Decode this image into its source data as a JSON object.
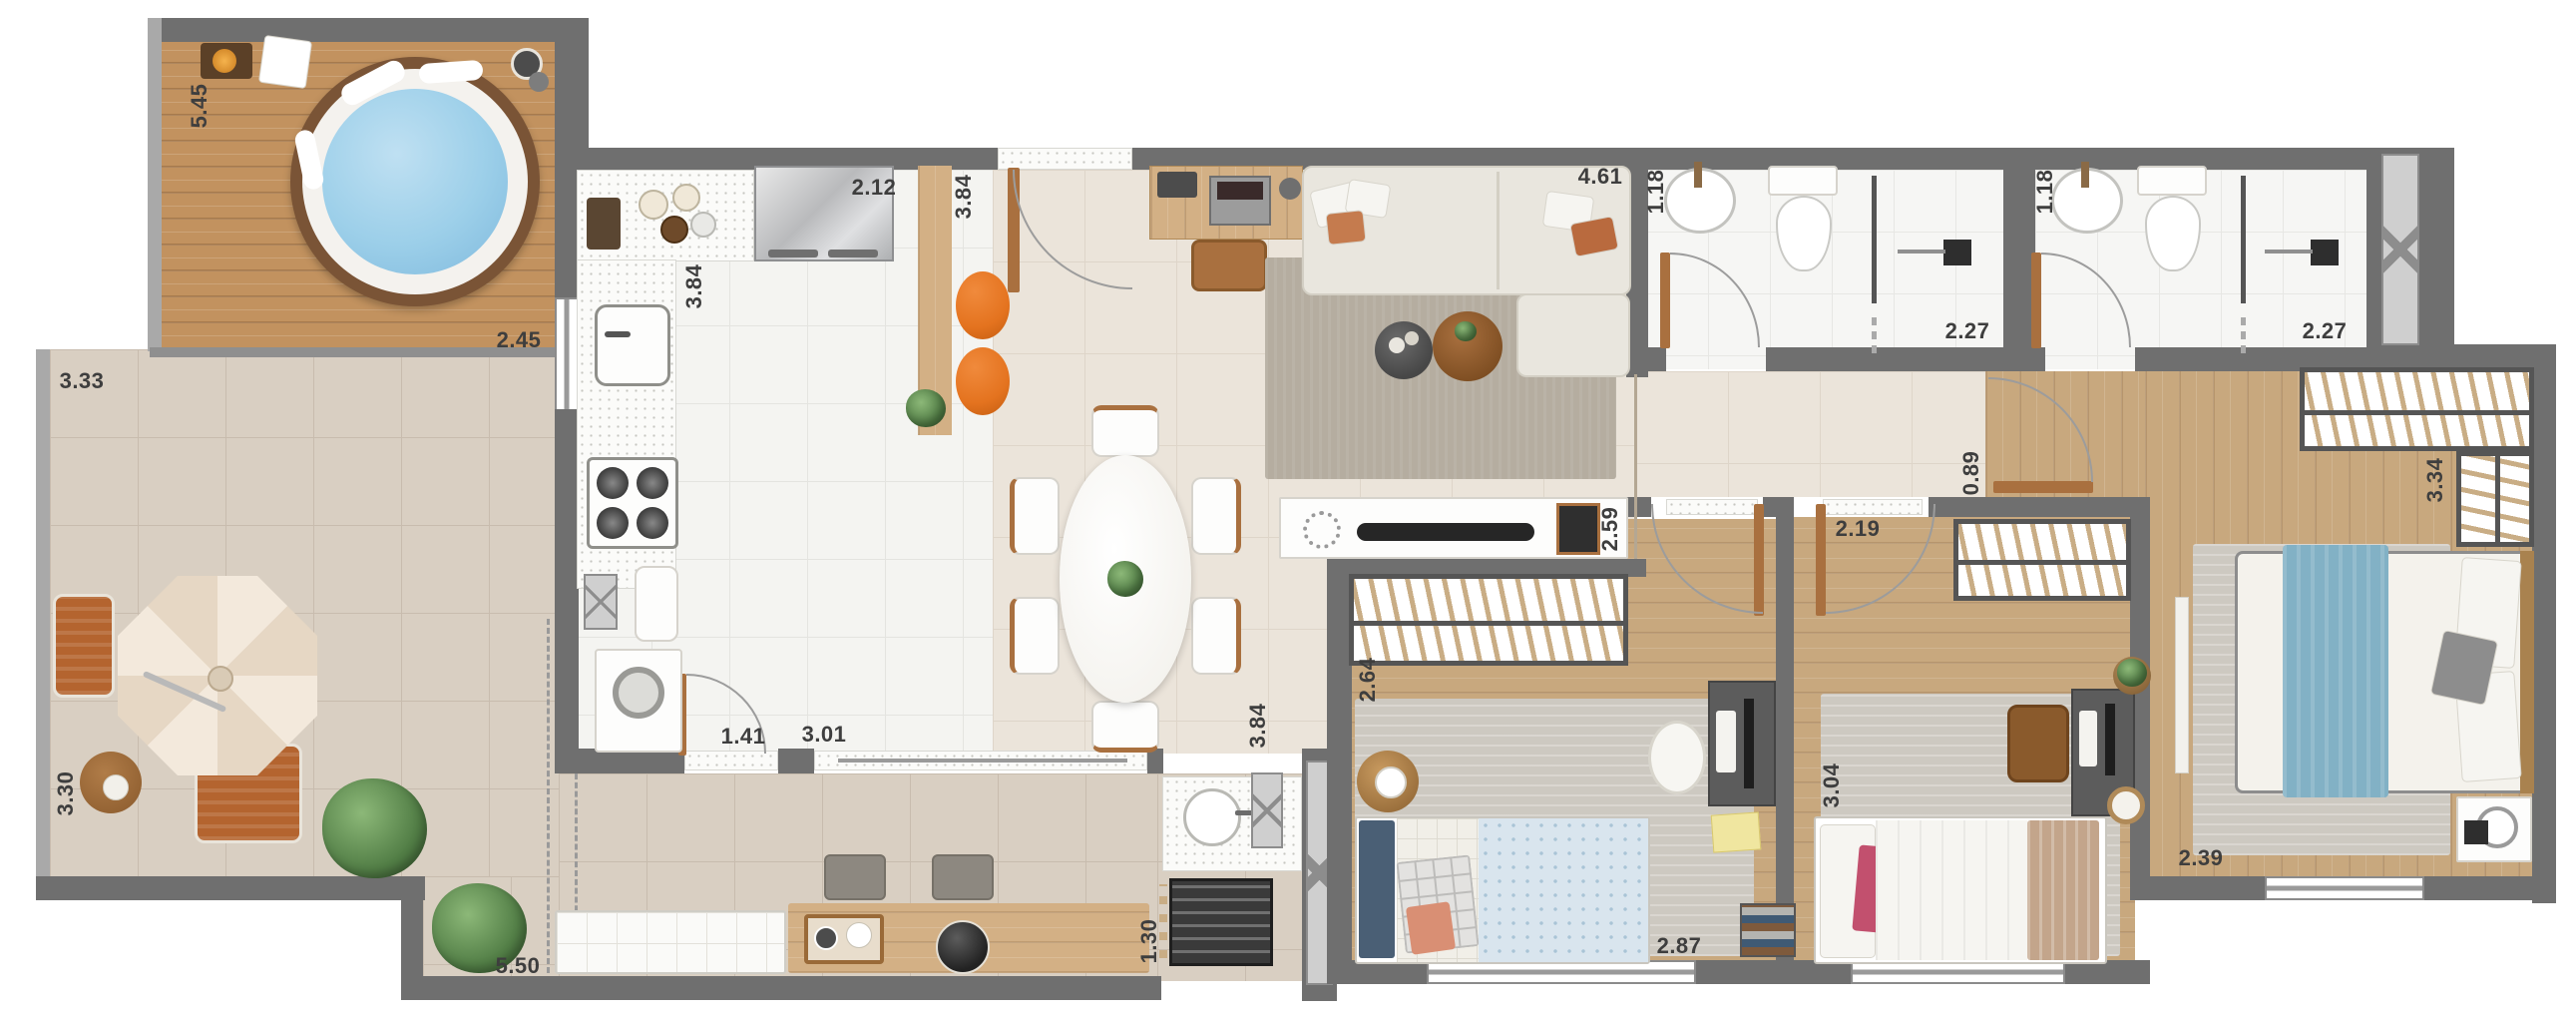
{
  "plan": {
    "title": "apartment-floor-plan-top-view",
    "colors": {
      "wall": "#6f6f6f",
      "parapet": "#a9a9a9",
      "deck_wood": "#c2925f",
      "interior_wood": "#c8a87e",
      "terrace_tile": "#d9cfc2",
      "kitchen_tile": "#f4f4f1",
      "social_tile": "#ebe4da",
      "hot_tub_water": "#9ccfe9",
      "stool_orange": "#e4731f",
      "bed_runner_blue": "#82b1c5",
      "living_rug": "#b5ada0"
    }
  },
  "dimensions": {
    "deck_length": "5.45",
    "deck_width": "2.45",
    "terrace_width": "3.33",
    "terrace_length": "3.30",
    "kitchen_counter": "2.12",
    "kitchen_depth": "3.84",
    "entry_depth": "3.84",
    "service_depth": "3.84",
    "living_width": "4.61",
    "bath1_width": "1.18",
    "bath1_length": "2.27",
    "bath2_width": "1.18",
    "bath2_length": "2.27",
    "hall_width": "0.89",
    "closet_length": "3.34",
    "tv_wall": "2.59",
    "bedroom1_depth": "2.64",
    "bedroom1_width": "2.87",
    "bedroom2_width": "2.19",
    "bedroom2_depth": "3.04",
    "master_width": "2.39",
    "laundry_width": "1.41",
    "kitchen_opening": "3.01",
    "grill_width": "1.30",
    "terrace_bottom_length": "5.50"
  }
}
